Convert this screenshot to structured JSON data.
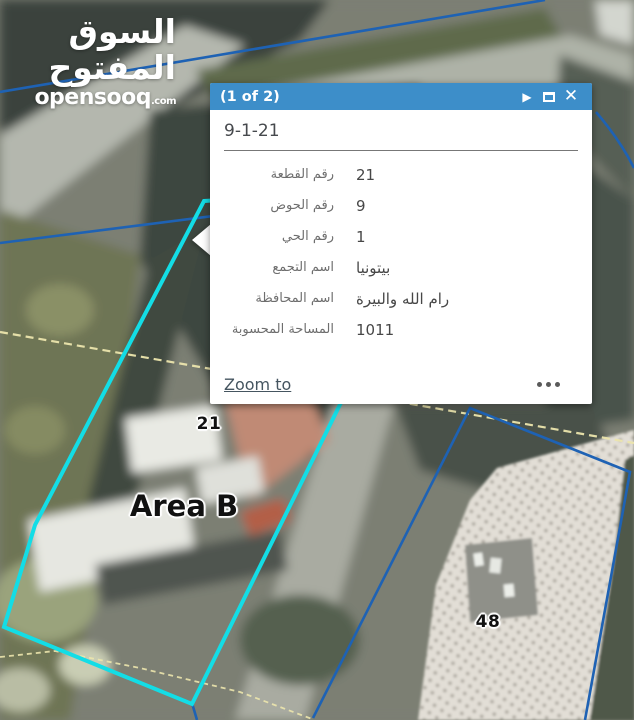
{
  "watermark": {
    "arabic": "السوق المفتوح",
    "latin": "opensooq",
    "tld": ".com"
  },
  "popup": {
    "header": {
      "pager": "(1 of 2)",
      "play_icon": "▶",
      "close_icon": "✕"
    },
    "title": "9-1-21",
    "fields": [
      {
        "label": "رقم القطعة",
        "value": "21"
      },
      {
        "label": "رقم الحوض",
        "value": "9"
      },
      {
        "label": "رقم الحي",
        "value": "1"
      },
      {
        "label": "اسم التجمع",
        "value": "بيتونيا"
      },
      {
        "label": "اسم المحافظة",
        "value": "رام الله والبيرة"
      },
      {
        "label": "المساحة المحسوبة",
        "value": "1011"
      }
    ],
    "footer": {
      "zoom_to": "Zoom to"
    },
    "colors": {
      "header": "#3d8ec9"
    }
  },
  "map": {
    "labels": [
      {
        "text": "21"
      },
      {
        "text": "Area B"
      },
      {
        "text": "48"
      }
    ],
    "colors": {
      "parcel_highlight": "#13dde6",
      "boundary_blue": "#1e62b4",
      "survey_yellow": "#ece5ad"
    }
  }
}
